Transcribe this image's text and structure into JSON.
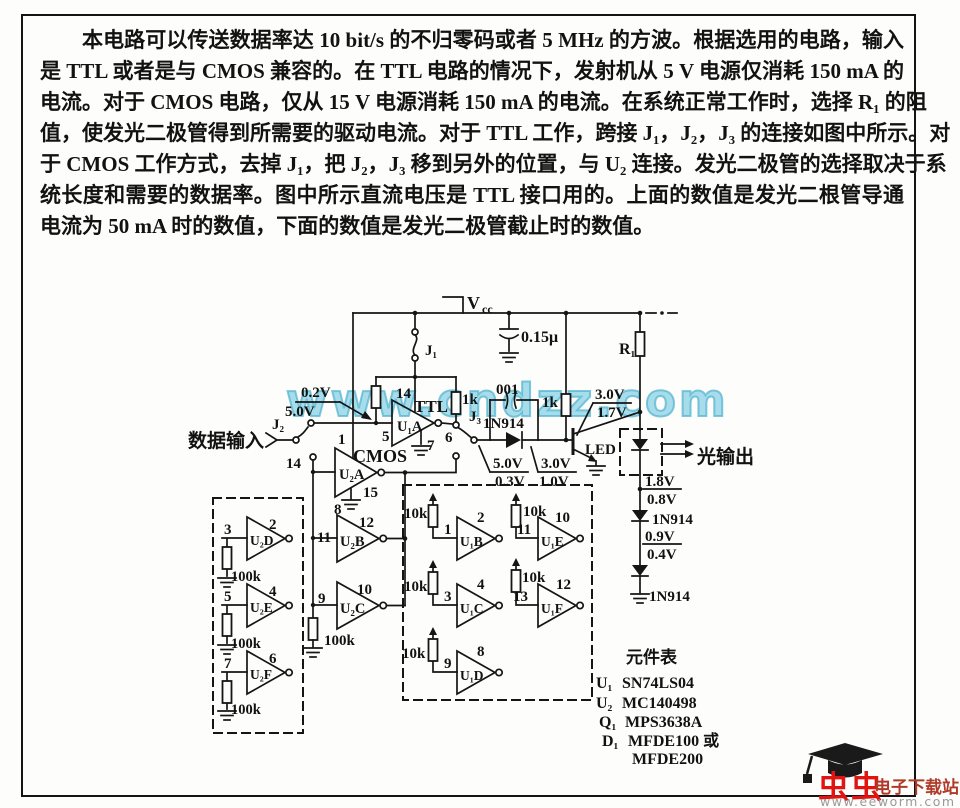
{
  "paragraph": {
    "lines": [
      "本电路可以传送数据率达 10 bit/s 的不归零码或者 5 MHz 的方波。根据选用的电路，输入",
      "是 TTL 或者是与 CMOS 兼容的。在 TTL 电路的情况下，发射机从 5 V 电源仅消耗 150 mA 的",
      "电流。对于 CMOS 电路，仅从 15 V 电源消耗 150 mA 的电流。在系统正常工作时，选择 R₁ 的阻",
      "值，使发光二极管得到所需要的驱动电流。对于 TTL 工作，跨接 J₁，J₂，J₃ 的连接如图中所示。对",
      "于 CMOS 工作方式，去掉 J₁，把 J₂，J₃ 移到另外的位置，与 U₂ 连接。发光二极管的选择取决于系",
      "统长度和需要的数据率。图中所示直流电压是 TTL 接口用的。上面的数值是发光二根管导通",
      "电流为 50 mA 时的数值，下面的数值是发光二极管截止时的数值。"
    ]
  },
  "watermark": {
    "text": "www.cndzz.com",
    "color": "#82cee4"
  },
  "schematic": {
    "labels": {
      "vcc_v": "V",
      "vcc_cc": "cc",
      "j1": "J₁",
      "j2": "J₂",
      "j3": "J₃",
      "c_main": "0.15μ",
      "c_small": "001",
      "r1": "R₁",
      "r1k": "1k",
      "r10k": "10k",
      "r100k": "100k",
      "ttl": "TTL",
      "cmos": "CMOS",
      "data_input": "数据输入",
      "light_output": "光输出",
      "u1a": "U₁A",
      "u1b": "U₁B",
      "u1c": "U₁C",
      "u1d": "U₁D",
      "u1e": "U₁E",
      "u1f": "U₁F",
      "u2a": "U₂A",
      "u2b": "U₂B",
      "u2c": "U₂C",
      "u2d": "U₂D",
      "u2e": "U₂E",
      "u2f": "U₂F",
      "d1n914": "1N914",
      "n1": "1",
      "n2": "2",
      "n3": "3",
      "n4": "4",
      "n5": "5",
      "n6": "6",
      "n7": "7",
      "n8": "8",
      "n9": "9",
      "n10": "10",
      "n11": "11",
      "n12": "12",
      "n13": "13",
      "n14": "14",
      "n15": "15",
      "v02": "0.2V",
      "v50": "5.0V",
      "v30": "3.0V",
      "v17": "1.7V",
      "v03": "0.3V",
      "v10": "1.0V",
      "v18": "1.8V",
      "v08": "0.8V",
      "v09": "0.9V",
      "v04": "0.4V"
    }
  },
  "parts_list": {
    "title": "元件表",
    "items": [
      {
        "ref": "U₁",
        "value": "SN74LS04"
      },
      {
        "ref": "U₂",
        "value": "MC140498"
      },
      {
        "ref": "Q₁",
        "value": "MPS3638A"
      },
      {
        "ref": "D₁",
        "value": "MFDE100 或"
      },
      {
        "ref": "",
        "value": "MFDE200"
      }
    ]
  },
  "logo": {
    "brand": "虫虫",
    "site_name": "电子下载站",
    "url": "www.eeworm.com",
    "brand_color": "#e01411",
    "site_color": "#b03a2a"
  }
}
